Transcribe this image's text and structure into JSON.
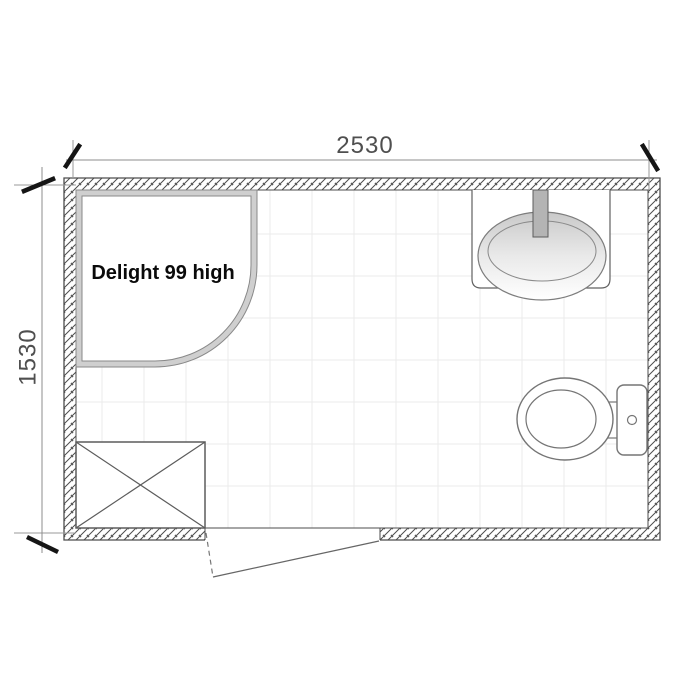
{
  "plan": {
    "kind": "bathroom-floor-plan"
  },
  "dimensions": {
    "width_label": "2530",
    "height_label": "1530"
  },
  "fixtures": {
    "shower": {
      "label": "Delight 99 high",
      "name": "quadrant-shower-enclosure"
    },
    "sink": {
      "name": "oval-countertop-basin"
    },
    "toilet": {
      "name": "toilet-with-cistern"
    },
    "washing_machine": {
      "name": "appliance-crossed-box"
    },
    "door": {
      "name": "outward-swing-door"
    }
  },
  "colors": {
    "background": "#ffffff",
    "wall_line": "#4d4d4d",
    "wall_hatch": "#4d4d4d",
    "tile_grid": "#ebebeb",
    "fixture_outline": "#757575",
    "shower_band": "#cfcfcf",
    "tap_fill": "#b4b4b4",
    "dimension_line": "#8c8c8c",
    "extension_line": "#9a9a9a",
    "tick_mark": "#151515",
    "dimension_text": "#4f4f4f",
    "label_text": "#0a0a0a"
  }
}
